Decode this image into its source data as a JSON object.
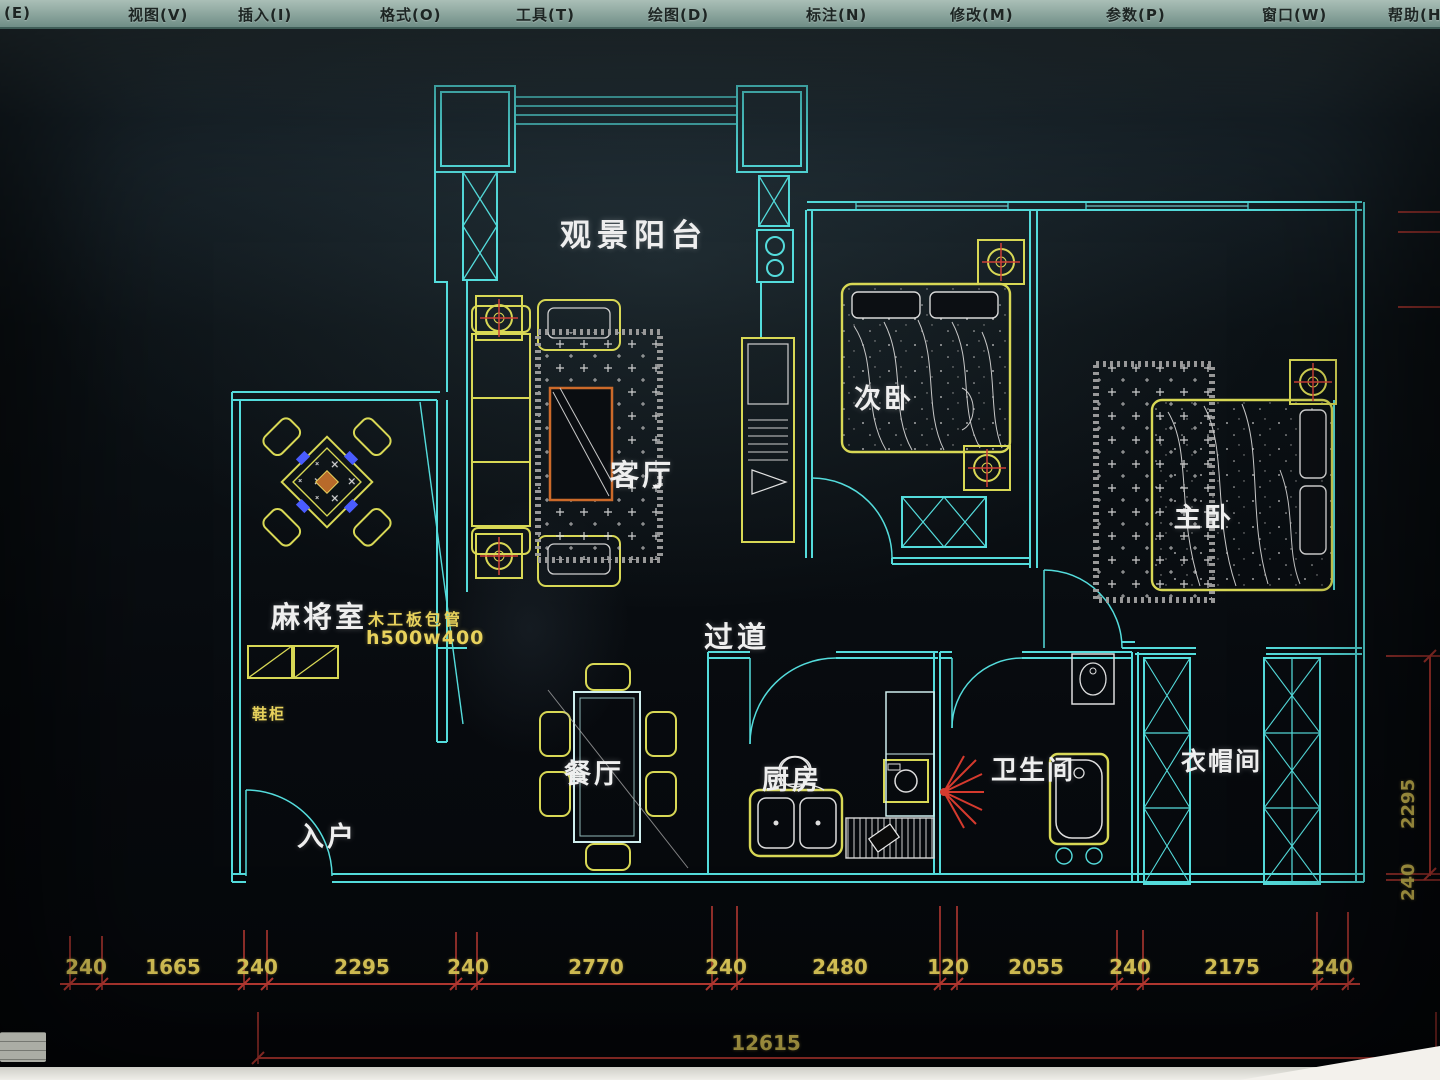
{
  "app": {
    "menu": [
      "(E)",
      "视图(V)",
      "插入(I)",
      "格式(O)",
      "工具(T)",
      "绘图(D)",
      "标注(N)",
      "修改(M)",
      "参数(P)",
      "窗口(W)",
      "帮助(H)"
    ]
  },
  "plan": {
    "rooms": {
      "balcony": "观景阳台",
      "living": "客厅",
      "hallway": "过道",
      "mahjong": "麻将室",
      "entry": "入户",
      "dining": "餐厅",
      "kitchen": "厨房",
      "bathroom": "卫生间",
      "cloakroom": "衣帽间",
      "second_bedroom": "次卧",
      "master_bedroom": "主卧"
    },
    "annotations": {
      "duct_note_line1": "木工板包管",
      "duct_note_line2": "h500w400",
      "shoe_cabinet": "鞋柜"
    }
  },
  "dimensions": {
    "bottom_chain": [
      "240",
      "1665",
      "240",
      "2295",
      "240",
      "2770",
      "240",
      "2480",
      "120",
      "2055",
      "240",
      "2175",
      "240"
    ],
    "bottom_total": "12615",
    "right_chain": [
      "2295",
      "240"
    ]
  },
  "colors": {
    "wall": "#54dcdc",
    "furniture": "#d8d855",
    "dimension_line": "#cf4038",
    "dimension_text": "#e8d25c",
    "label": "#efefef",
    "accent_orange": "#cc6a2a",
    "accent_blue": "#4a5cff"
  }
}
